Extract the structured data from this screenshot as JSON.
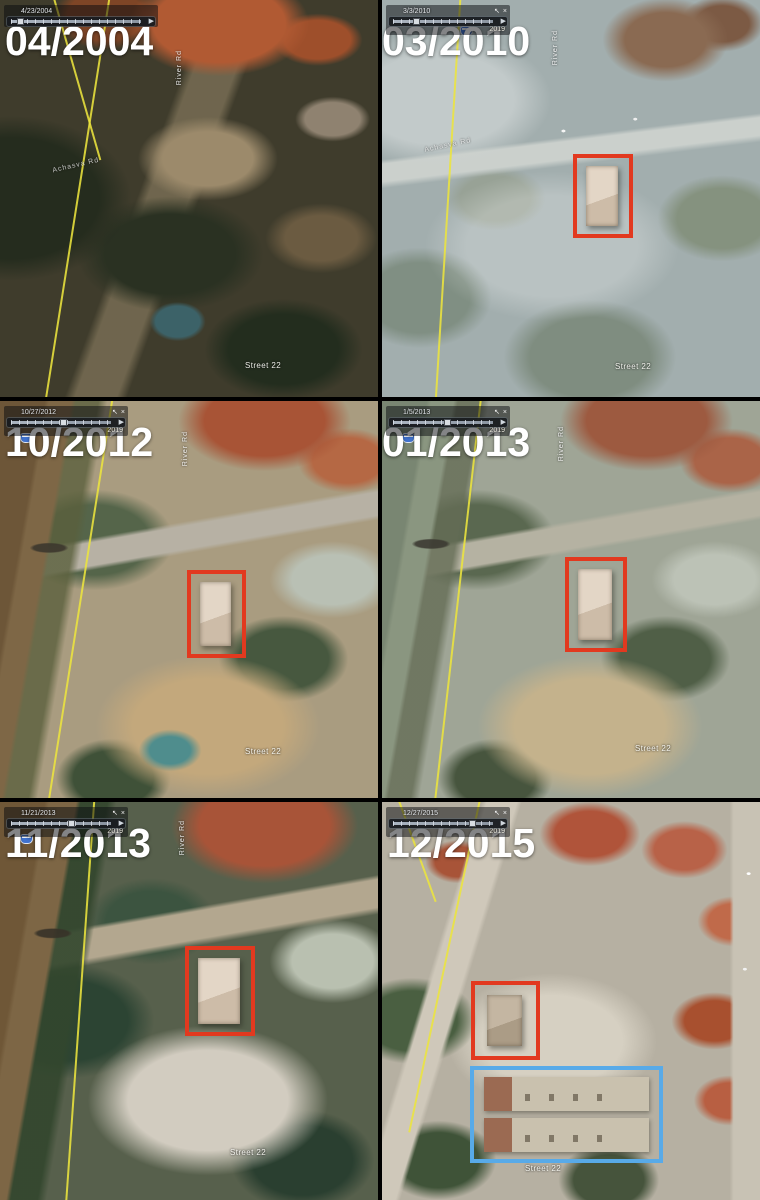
{
  "colors": {
    "highlight_red": "#e2391f",
    "highlight_blue": "#58aae8",
    "route_line_yellow": "#ece43e"
  },
  "icons": {
    "pan": "↖",
    "close": "×",
    "play": "▶"
  },
  "panels": [
    {
      "date_label": "04/2004",
      "timeline_date": "4/23/2004",
      "timeline_end": "",
      "street_label": "Street 22",
      "road_label": "Achasva Rd",
      "vertical_road_label": "River Rd"
    },
    {
      "date_label": "03/2010",
      "timeline_date": "3/3/2010",
      "timeline_end": "2019",
      "street_label": "Street 22",
      "road_label": "Achasva Rd",
      "vertical_road_label": "River Rd"
    },
    {
      "date_label": "10/2012",
      "timeline_date": "10/27/2012",
      "timeline_end": "2019",
      "street_label": "Street 22",
      "road_label": "",
      "vertical_road_label": "River Rd"
    },
    {
      "date_label": "01/2013",
      "timeline_date": "1/5/2013",
      "timeline_end": "2019",
      "street_label": "Street 22",
      "road_label": "",
      "vertical_road_label": "River Rd"
    },
    {
      "date_label": "11/2013",
      "timeline_date": "11/21/2013",
      "timeline_end": "2019",
      "street_label": "Street 22",
      "road_label": "",
      "vertical_road_label": "River Rd"
    },
    {
      "date_label": "12/2015",
      "timeline_date": "12/27/2015",
      "timeline_end": "2019",
      "street_label": "Street 22",
      "road_label": "",
      "vertical_road_label": ""
    }
  ]
}
